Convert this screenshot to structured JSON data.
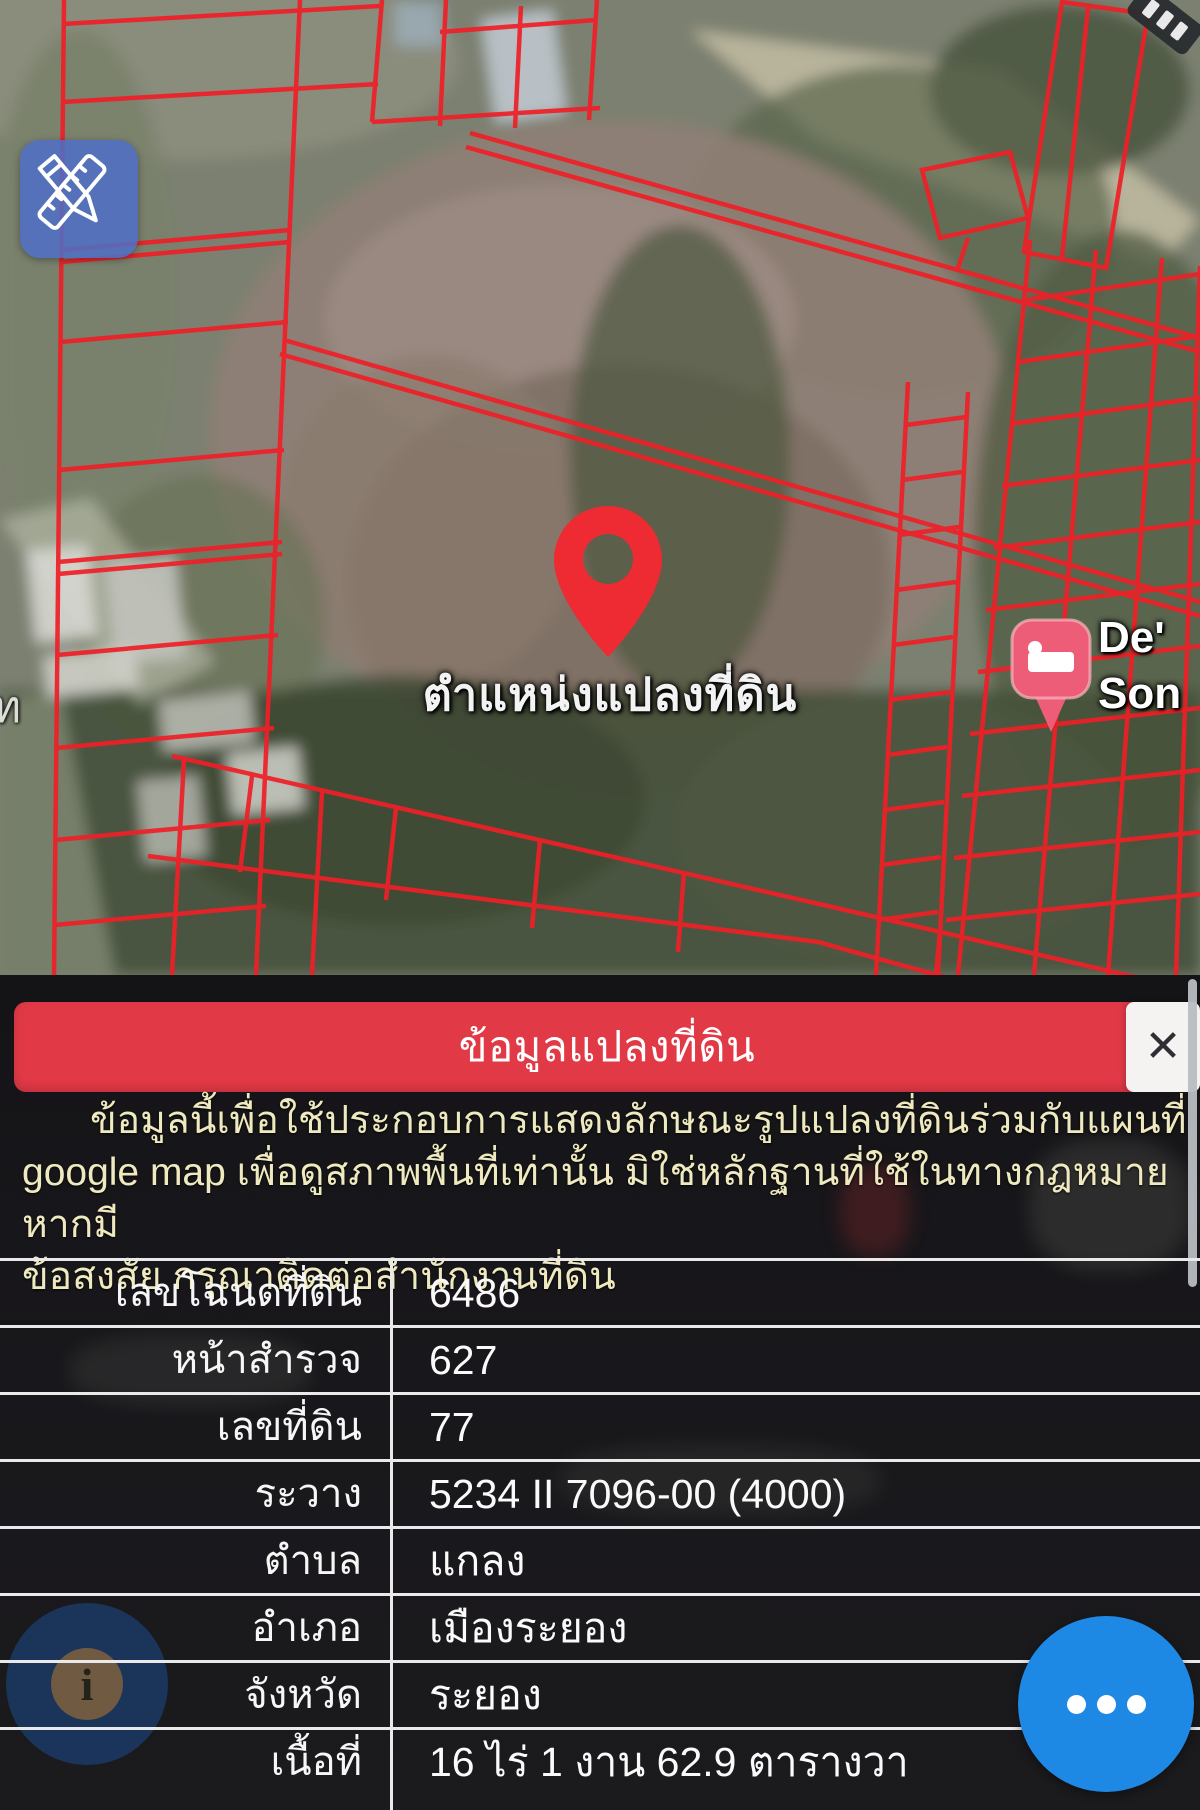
{
  "map": {
    "pin_label": "ตำแหน่งแปลงที่ดิน",
    "lodging_label_line1": "De'",
    "lodging_label_line2": "Son",
    "partial_road_label": "ท",
    "colors": {
      "parcel_line": "#ef1f27",
      "location_pin": "#ee2a33",
      "edit_button": "#4e6ec4",
      "lodging_pin": "#ee5d78"
    }
  },
  "sheet": {
    "title": "ข้อมูลแปลงที่ดิน",
    "close_icon": "✕",
    "disclaimer_lines": [
      "ข้อมูลนี้เพื่อใช้ประกอบการแสดงลักษณะรูปแปลงที่ดินร่วมกับแผนที่",
      "google map เพื่อดูสภาพพื้นที่เท่านั้น มิใช่หลักฐานที่ใช้ในทางกฎหมาย หากมี",
      "ข้อสงสัย กรุณาติดต่อสำนักงานที่ดิน"
    ],
    "table": {
      "rows": [
        {
          "label": "เลขโฉนดที่ดิน",
          "value": "6486"
        },
        {
          "label": "หน้าสำรวจ",
          "value": "627"
        },
        {
          "label": "เลขที่ดิน",
          "value": "77"
        },
        {
          "label": "ระวาง",
          "value": "5234 II 7096-00 (4000)"
        },
        {
          "label": "ตำบล",
          "value": "แกลง"
        },
        {
          "label": "อำเภอ",
          "value": "เมืองระยอง"
        },
        {
          "label": "จังหวัด",
          "value": "ระยอง"
        },
        {
          "label": "เนื้อที่",
          "value": "16 ไร่ 1 งาน 62.9 ตารางวา"
        }
      ]
    },
    "colors": {
      "header_bar": "#e23947",
      "disclaimer_text": "#efe9bf",
      "more_button": "#1e88e5"
    }
  }
}
